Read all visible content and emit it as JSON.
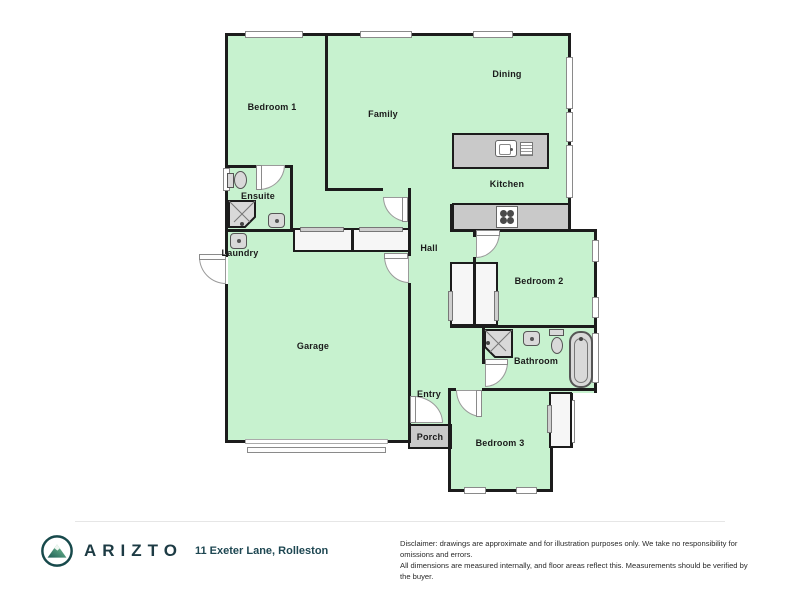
{
  "brand": {
    "name": "ARIZTO"
  },
  "listing": {
    "address": "11 Exeter Lane, Rolleston"
  },
  "disclaimer": {
    "line1": "Disclaimer: drawings are approximate and for illustration purposes only. We take no responsibility for omissions and errors.",
    "line2": "All dimensions are measured internally, and floor areas reflect this. Measurements should be verified by the buyer."
  },
  "floorplan": {
    "rooms": [
      {
        "label": "Bedroom 1"
      },
      {
        "label": "Family"
      },
      {
        "label": "Dining"
      },
      {
        "label": "Kitchen"
      },
      {
        "label": "Ensuite"
      },
      {
        "label": "Laundry"
      },
      {
        "label": "Hall"
      },
      {
        "label": "Garage"
      },
      {
        "label": "Bedroom 2"
      },
      {
        "label": "Bathroom"
      },
      {
        "label": "Entry"
      },
      {
        "label": "Porch"
      },
      {
        "label": "Bedroom 3"
      }
    ],
    "fixtures": [
      "toilet",
      "shower",
      "basin",
      "bath",
      "laundry-tub",
      "kitchen-sink",
      "drainer",
      "cooktop",
      "wardrobe",
      "garage-door"
    ],
    "colors": {
      "room_fill": "#c7f2cf",
      "wall": "#1c1c1c",
      "counter_gray": "#c9c9c9",
      "brand_teal": "#1d3b44",
      "logo_green": "#6cbf8c"
    }
  }
}
